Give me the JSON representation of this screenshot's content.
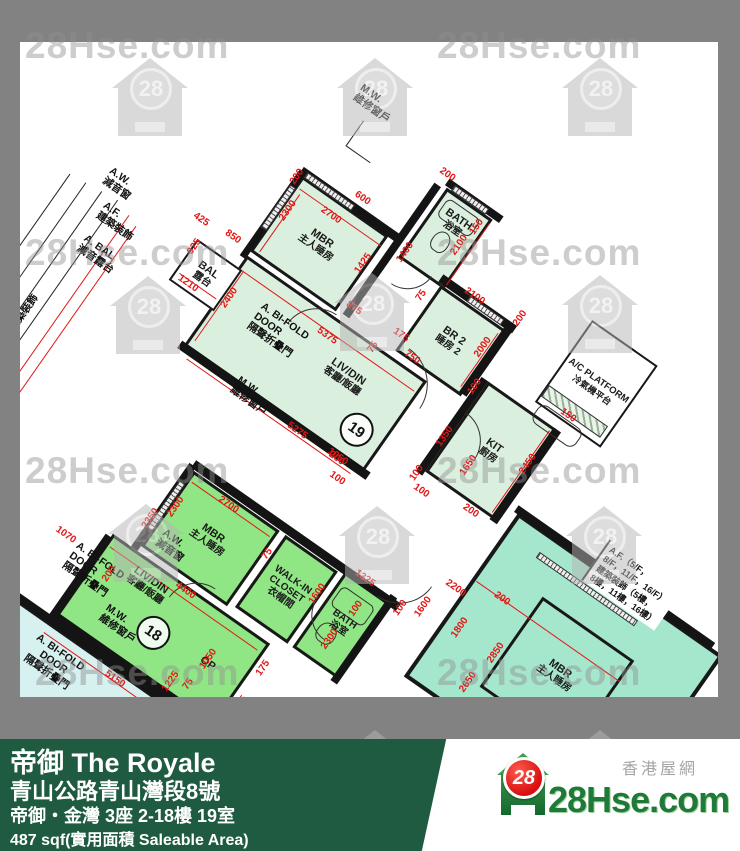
{
  "watermark": {
    "text": "28Hse.com",
    "logo_number": "28",
    "texts": [
      {
        "x": 25,
        "y": 25
      },
      {
        "x": 437,
        "y": 25
      },
      {
        "x": 25,
        "y": 232
      },
      {
        "x": 437,
        "y": 232
      },
      {
        "x": 25,
        "y": 450
      },
      {
        "x": 437,
        "y": 450
      },
      {
        "x": 35,
        "y": 652
      },
      {
        "x": 437,
        "y": 652
      }
    ],
    "logos": [
      {
        "x": 150,
        "y": 100
      },
      {
        "x": 375,
        "y": 100
      },
      {
        "x": 600,
        "y": 100
      },
      {
        "x": 148,
        "y": 318
      },
      {
        "x": 372,
        "y": 315
      },
      {
        "x": 600,
        "y": 317
      },
      {
        "x": 146,
        "y": 546
      },
      {
        "x": 377,
        "y": 548
      },
      {
        "x": 604,
        "y": 548
      },
      {
        "x": 375,
        "y": 772
      },
      {
        "x": 600,
        "y": 772
      }
    ]
  },
  "plan": {
    "u19": {
      "mbr": {
        "l1": "MBR",
        "l2": "主人睡房"
      },
      "bath": {
        "l1": "BATH",
        "l2": "浴室"
      },
      "br2": {
        "l1": "BR 2",
        "l2": "睡房 2"
      },
      "liv": {
        "l1": "LIV/DIN",
        "l2": "客廳/飯廳",
        "num": "19"
      },
      "kit": {
        "l1": "KIT",
        "l2": "廚房"
      },
      "acp": {
        "l1": "A/C PLATFORM",
        "l2": "冷氣機平台"
      },
      "bal": {
        "l1": "BAL",
        "l2": "露台"
      }
    },
    "u18": {
      "mbr": {
        "l1": "MBR",
        "l2": "主人睡房"
      },
      "wic": {
        "l1": "WALK-IN",
        "l2": "CLOSET",
        "l3": "衣帽間"
      },
      "liv": {
        "l1": "LIV/DIN",
        "l2": "客廳/飯廳",
        "num": "18"
      },
      "bath": {
        "l1": "BATH",
        "l2": "浴室"
      },
      "openkit": "OP"
    },
    "se": {
      "mbr": {
        "l1": "MBR",
        "l2": "主人睡房"
      },
      "af_note": {
        "l1": "A.F.（5/F，",
        "l2": "8/F，11/F，16/F）",
        "l3": "建築裝飾（5樓，",
        "l4": "8樓，11樓，16樓）"
      }
    },
    "sw": {
      "bifold": {
        "l1": "A. BI-FOLD",
        "l2": "DOOR",
        "l3": "隔聲折疊門"
      },
      "liv": "LIV"
    },
    "annos": {
      "mw_top": {
        "l1": "M.W.",
        "l2": "維修窗戶"
      },
      "aw_left": {
        "l1": "A.W.",
        "l2": "減音窗"
      },
      "af_left": {
        "l1": "A.F.",
        "l2": "建築裝飾"
      },
      "abal": {
        "l1": "A. BAL",
        "l2": "減音露台"
      },
      "bifold19": {
        "l1": "A. BI-FOLD",
        "l2": "DOOR",
        "l3": "隔聲折疊門"
      },
      "mw19": {
        "l1": "M.W.",
        "l2": "維修窗戶"
      },
      "af_vert": {
        "l1": "A.F.",
        "l2": "建築裝飾"
      },
      "aw18": {
        "l1": "A.W.",
        "l2": "減音窗"
      },
      "mw18": {
        "l1": "M.W.",
        "l2": "維修窗戶"
      },
      "bifold18": {
        "l1": "A. BI-FOLD",
        "l2": "DOOR",
        "l3": "隔聲折疊門"
      }
    },
    "dims": [
      {
        "t": "600",
        "x": 212,
        "y": 2,
        "r": 0
      },
      {
        "t": "2700",
        "x": 196,
        "y": 34,
        "r": 0
      },
      {
        "t": "2300",
        "x": 158,
        "y": 55,
        "r": -90
      },
      {
        "t": "200",
        "x": 146,
        "y": 22,
        "r": -90
      },
      {
        "t": "1425",
        "x": 250,
        "y": 55,
        "r": -90
      },
      {
        "t": "150",
        "x": 322,
        "y": -40,
        "r": -90
      },
      {
        "t": "200",
        "x": 268,
        "y": -66,
        "r": 0
      },
      {
        "t": "1400",
        "x": 278,
        "y": 22,
        "r": -90
      },
      {
        "t": "2100",
        "x": 318,
        "y": -15,
        "r": -90
      },
      {
        "t": "75",
        "x": 316,
        "y": 48,
        "r": -90
      },
      {
        "t": "175",
        "x": 322,
        "y": 92,
        "r": 0
      },
      {
        "t": "750",
        "x": 344,
        "y": 104,
        "r": 0
      },
      {
        "t": "875",
        "x": 268,
        "y": 97,
        "r": 0
      },
      {
        "t": "75",
        "x": 306,
        "y": 118,
        "r": -90
      },
      {
        "t": "5375",
        "x": 262,
        "y": 135,
        "r": 0
      },
      {
        "t": "2400",
        "x": 160,
        "y": 160,
        "r": -90
      },
      {
        "t": "5275",
        "x": 292,
        "y": 230,
        "r": 0
      },
      {
        "t": "2000",
        "x": 396,
        "y": 55,
        "r": -90
      },
      {
        "t": "2100",
        "x": 360,
        "y": 18,
        "r": 0
      },
      {
        "t": "200",
        "x": 410,
        "y": 10,
        "r": -90
      },
      {
        "t": "100",
        "x": 412,
        "y": 92,
        "r": -90
      },
      {
        "t": "1350",
        "x": 416,
        "y": 150,
        "r": -90
      },
      {
        "t": "100",
        "x": 414,
        "y": 196,
        "r": -90
      },
      {
        "t": "1050",
        "x": 340,
        "y": 228,
        "r": 0
      },
      {
        "t": "2450",
        "x": 500,
        "y": 125,
        "r": -90
      },
      {
        "t": "1650",
        "x": 452,
        "y": 160,
        "r": -90
      },
      {
        "t": "150",
        "x": 505,
        "y": 62,
        "r": 0
      },
      {
        "t": "200",
        "x": 480,
        "y": 196,
        "r": 0
      },
      {
        "t": "100",
        "x": 428,
        "y": 208,
        "r": 0
      },
      {
        "t": "925",
        "x": 102,
        "y": 138,
        "r": -90
      },
      {
        "t": "1210",
        "x": 118,
        "y": 172,
        "r": 0
      },
      {
        "t": "850",
        "x": 128,
        "y": 108,
        "r": 0
      },
      {
        "t": "425",
        "x": 92,
        "y": 112,
        "r": 0
      },
      {
        "t": "1070",
        "x": 162,
        "y": 448,
        "r": 0
      },
      {
        "t": "2700",
        "x": 278,
        "y": 330,
        "r": 0
      },
      {
        "t": "2300",
        "x": 236,
        "y": 362,
        "r": -90
      },
      {
        "t": "75",
        "x": 338,
        "y": 348,
        "r": -90
      },
      {
        "t": "1600",
        "x": 402,
        "y": 352,
        "r": -90
      },
      {
        "t": "4400",
        "x": 292,
        "y": 425,
        "r": 0
      },
      {
        "t": "2350",
        "x": 222,
        "y": 386,
        "r": -90
      },
      {
        "t": "5150",
        "x": 285,
        "y": 538,
        "r": 0
      },
      {
        "t": "1050",
        "x": 350,
        "y": 468,
        "r": -90
      },
      {
        "t": "75",
        "x": 348,
        "y": 500,
        "r": -90
      },
      {
        "t": "1225",
        "x": 332,
        "y": 508,
        "r": -90
      },
      {
        "t": "850",
        "x": 366,
        "y": 516,
        "r": -90
      },
      {
        "t": "375",
        "x": 402,
        "y": 486,
        "r": -90
      },
      {
        "t": "175",
        "x": 400,
        "y": 444,
        "r": -90
      },
      {
        "t": "2300",
        "x": 438,
        "y": 382,
        "r": -90
      },
      {
        "t": "100",
        "x": 442,
        "y": 342,
        "r": -90
      },
      {
        "t": "1325",
        "x": 432,
        "y": 312,
        "r": 0
      },
      {
        "t": "200",
        "x": 220,
        "y": 455,
        "r": -90
      },
      {
        "t": "2200",
        "x": 512,
        "y": 268,
        "r": 0
      },
      {
        "t": "1800",
        "x": 538,
        "y": 298,
        "r": -90
      },
      {
        "t": "1600",
        "x": 496,
        "y": 302,
        "r": -90
      },
      {
        "t": "200",
        "x": 556,
        "y": 250,
        "r": 0
      },
      {
        "t": "100",
        "x": 478,
        "y": 316,
        "r": -90
      },
      {
        "t": "2850",
        "x": 582,
        "y": 298,
        "r": -90
      },
      {
        "t": "2650",
        "x": 576,
        "y": 338,
        "r": -90
      },
      {
        "t": "2300",
        "x": 636,
        "y": 326,
        "r": 0
      },
      {
        "t": "75",
        "x": 690,
        "y": 340,
        "r": -90
      },
      {
        "t": "100",
        "x": 694,
        "y": 296,
        "r": -90
      },
      {
        "t": "200",
        "x": 340,
        "y": 230,
        "r": 0
      },
      {
        "t": "100",
        "x": 352,
        "y": 246,
        "r": 0
      }
    ]
  },
  "banner": {
    "title": "帝御 The Royale",
    "address": "青山公路青山灣段8號",
    "unit": "帝御・金灣 3座 2-18樓 19室",
    "area": "487 sqf(實用面積 Saleable Area)",
    "site_name": "28Hse.com",
    "site_tag": "香港屋網",
    "logo_number": "28"
  },
  "colors": {
    "flat19": "#daefdd",
    "flat18": "#90e584",
    "flat_se": "#a5e7cd",
    "flat_sw": "#d6f1ef",
    "frame_grey": "#828282",
    "banner_green": "#1e5b40",
    "dim_red": "#e31717"
  }
}
